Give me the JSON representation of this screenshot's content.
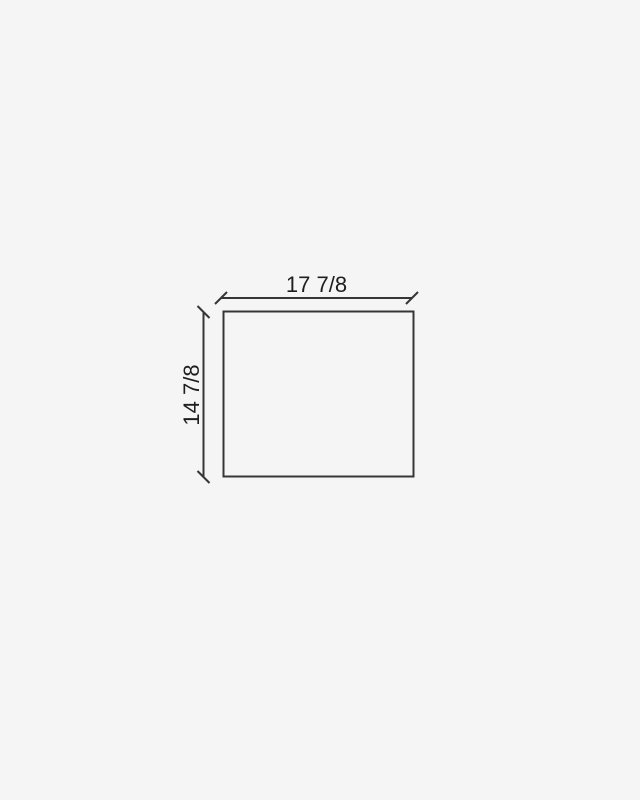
{
  "drawing": {
    "type": "dimensioned-rectangle",
    "width_dimension": {
      "label": "17 7/8"
    },
    "height_dimension": {
      "label": "14 7/8"
    },
    "colors": {
      "background": "#f5f5f5",
      "line": "#363636",
      "text": "#1e1e1e"
    }
  }
}
